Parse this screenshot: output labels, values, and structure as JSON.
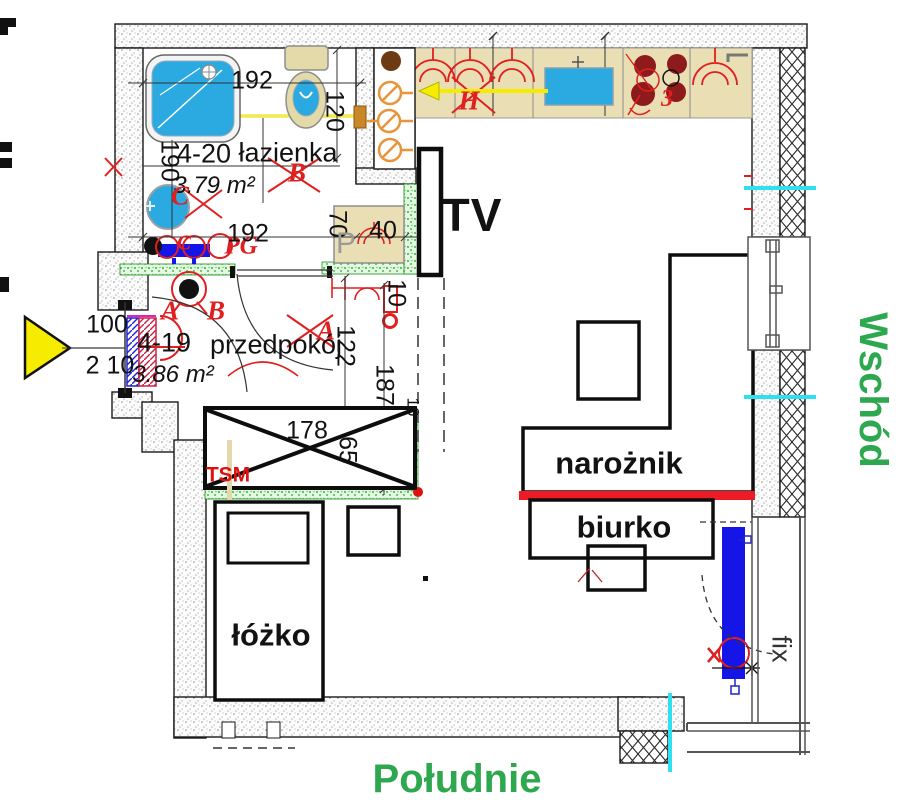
{
  "compass": {
    "east": "Wschód",
    "south": "Południe"
  },
  "rooms": {
    "bathroom": {
      "code": "4-20",
      "name": "łazienka",
      "area": "3.79 m²"
    },
    "hallway": {
      "code": "4-19",
      "name": "przedpokój",
      "area": "3.86 m²"
    }
  },
  "furniture": {
    "bed": "łóżko",
    "corner_sofa": "narożnik",
    "desk": "biurko",
    "tv": "TV",
    "washer": "P",
    "wardrobe_tag": "TSM",
    "fixed_glazing": "fix"
  },
  "dims": {
    "bath_width": "192",
    "bath_height": "120",
    "bath_left": "190",
    "bath_lower": "192",
    "washer_depth": "70",
    "washer_width": "40",
    "entry_width": "100",
    "entry_height": "2 10",
    "hall_width": "122",
    "hall_length": "187",
    "gap_a": "10",
    "gap_b": "10",
    "wardrobe_width": "178",
    "wardrobe_depth": "65"
  },
  "markers": {
    "lamp_a": "A",
    "lamp_b": "B",
    "bath_b": "B",
    "bath_c": "C",
    "rad_c": "C",
    "rad_pg": "PG",
    "hall_a": "A",
    "hood_h": "H",
    "stove": "3"
  },
  "colors": {
    "wall_green": "#2eb82e",
    "radiator_blue": "#1515e8",
    "water_blue": "#2BA9E1",
    "counter_beige": "#EADFB4",
    "accent_red": "#E02020",
    "thick_red": "#ED1C24",
    "compass_green": "#2EA84F",
    "highlight_yellow": "#F6EC00",
    "utility_cyan": "#2FE1F0",
    "burner_maroon": "#8E1B1B"
  }
}
